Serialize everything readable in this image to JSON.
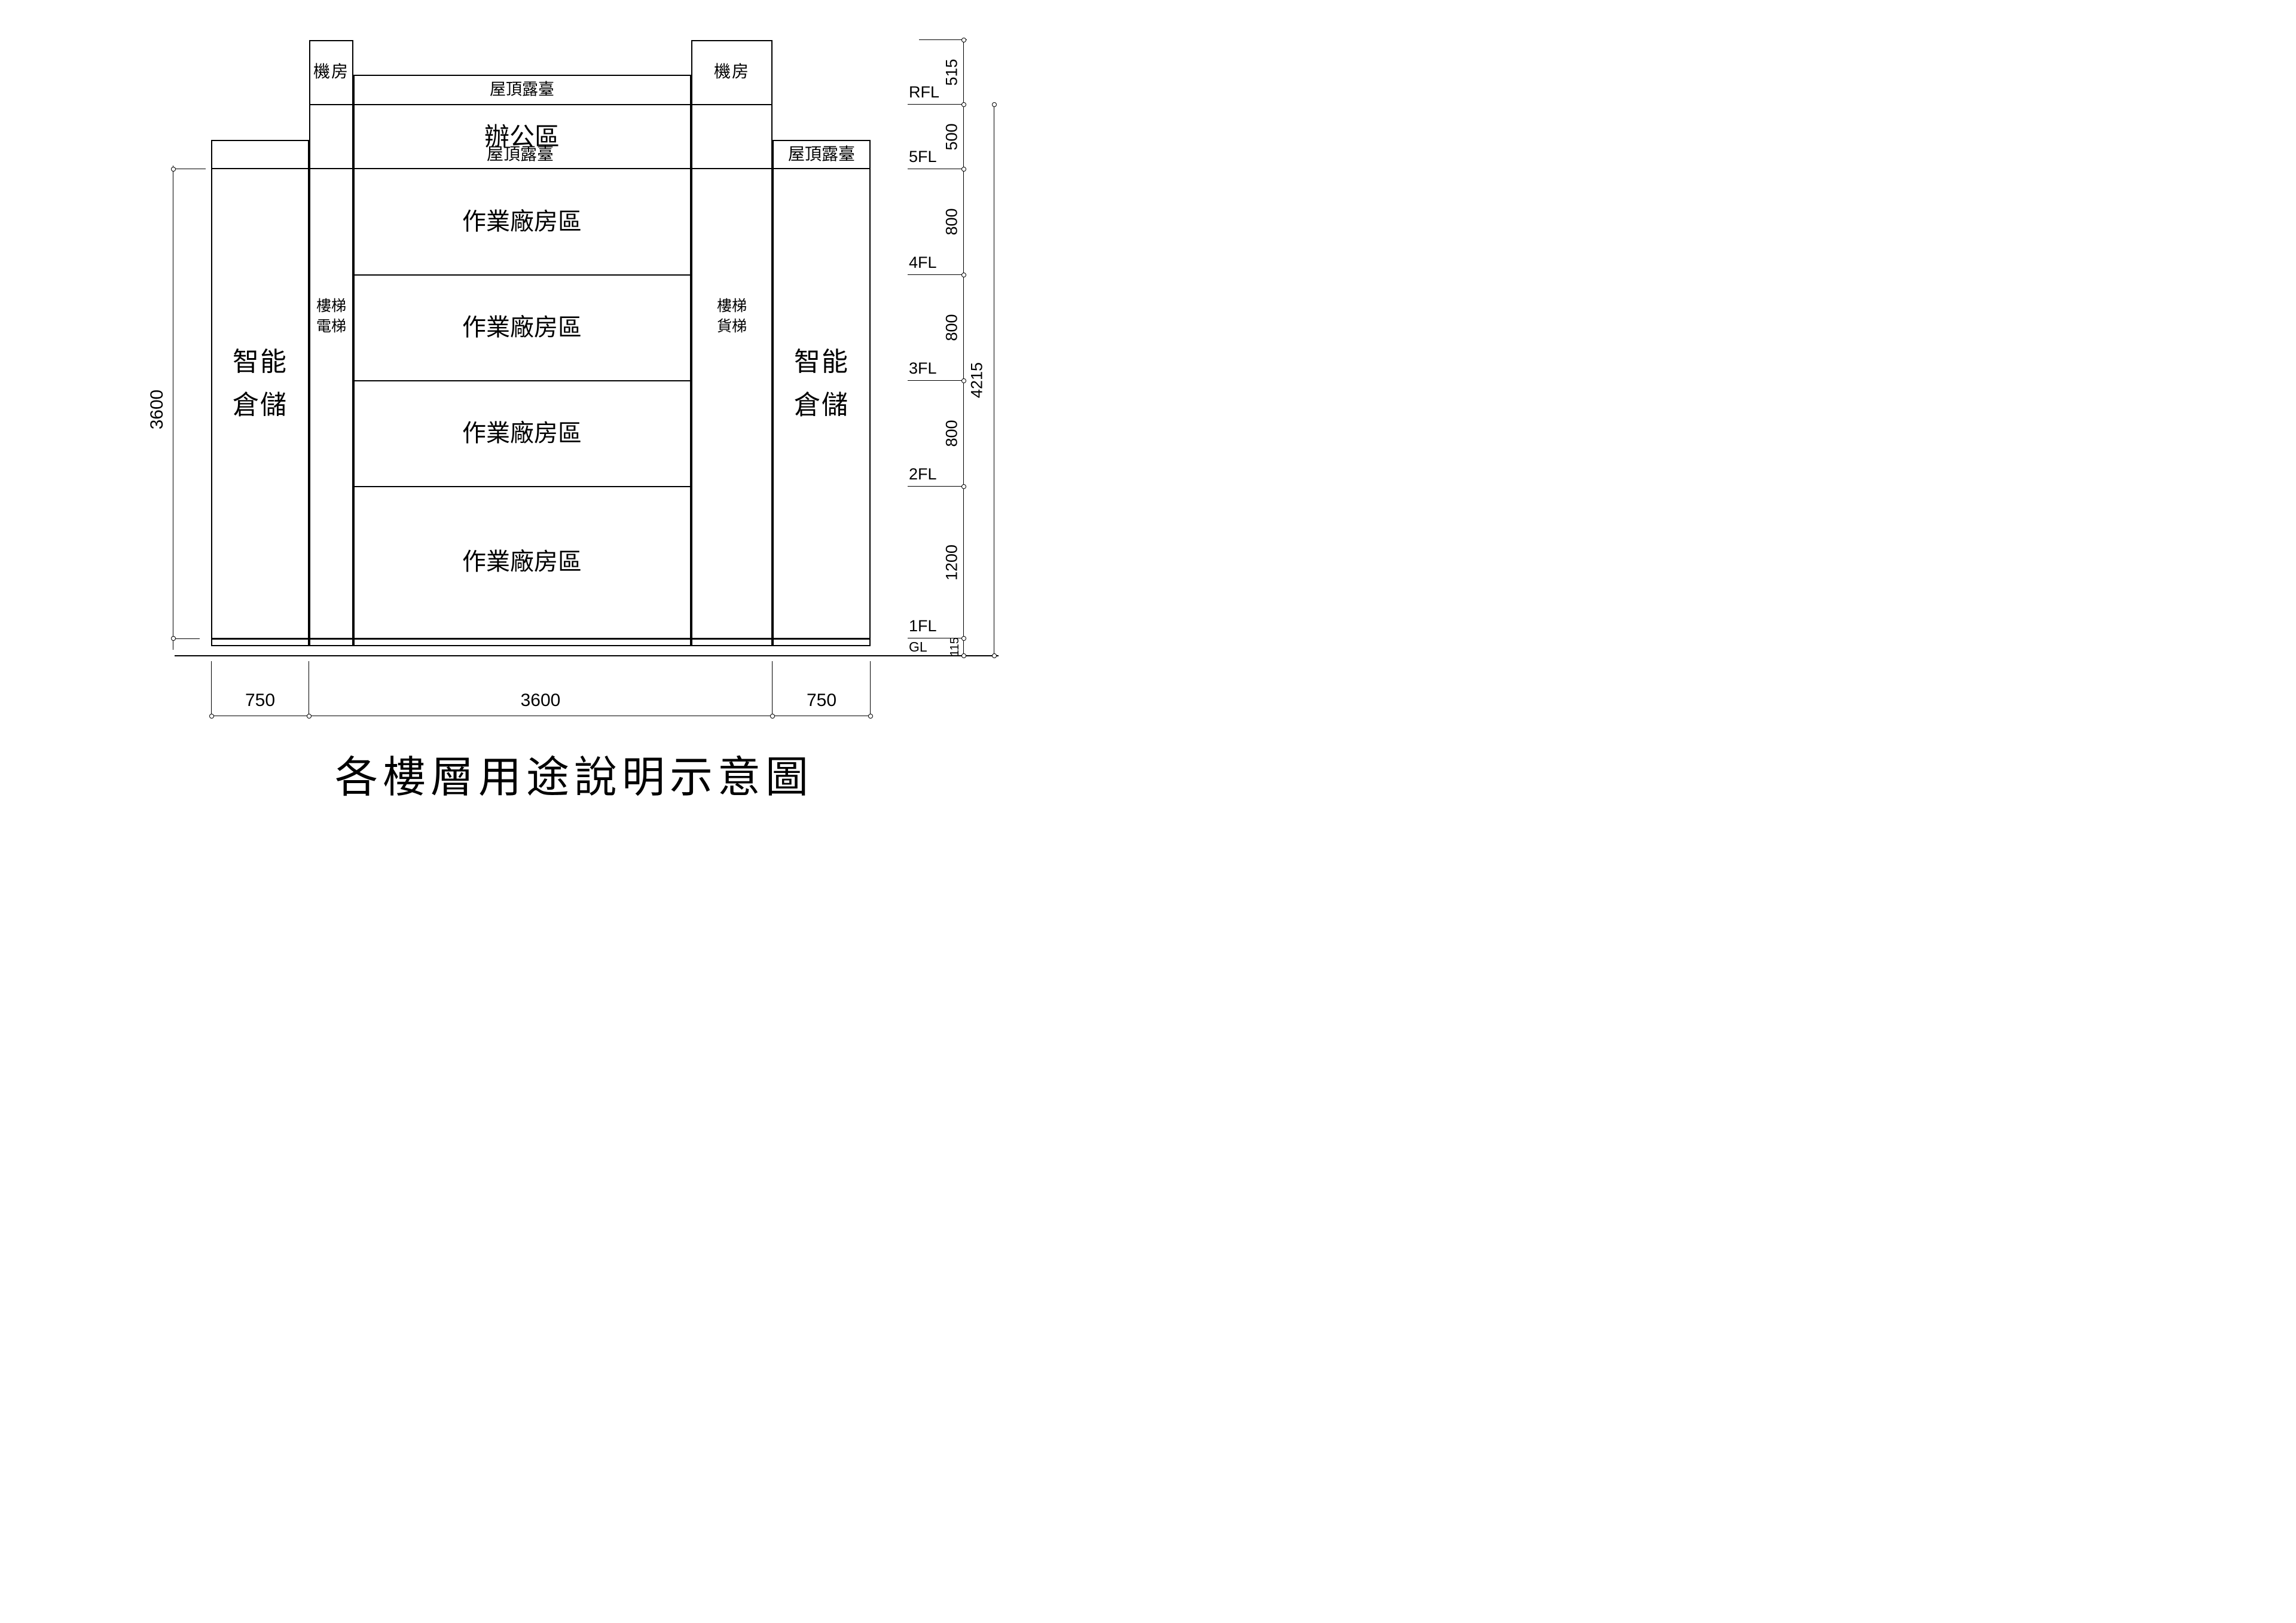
{
  "title": "各樓層用途說明示意圖",
  "building": {
    "machine_room_left": "機房",
    "machine_room_right": "機房",
    "roof_terrace_center": "屋頂露臺",
    "roof_terrace_left": "屋頂露臺",
    "roof_terrace_right": "屋頂露臺",
    "tower_left": {
      "line1": "智能",
      "line2": "倉儲"
    },
    "tower_right": {
      "line1": "智能",
      "line2": "倉儲"
    },
    "core_left": {
      "line1": "樓梯",
      "line2": "電梯"
    },
    "core_right": {
      "line1": "樓梯",
      "line2": "貨梯"
    },
    "floors": [
      "辦公區",
      "作業廠房區",
      "作業廠房區",
      "作業廠房區",
      "作業廠房區"
    ]
  },
  "levels": {
    "rfl": "RFL",
    "f5": "5FL",
    "f4": "4FL",
    "f3": "3FL",
    "f2": "2FL",
    "f1": "1FL",
    "gl": "GL"
  },
  "dimensions": {
    "vertical": {
      "machine_room": "515",
      "rfl_to_5fl": "500",
      "f5_to_f4": "800",
      "f4_to_f3": "800",
      "f3_to_f2": "800",
      "f2_to_f1": "1200",
      "f1_to_gl": "115",
      "total": "4215",
      "tower_height": "3600"
    },
    "horizontal": {
      "left_tower": "750",
      "center": "3600",
      "right_tower": "750"
    }
  },
  "colors": {
    "line": "#000000",
    "background": "#ffffff"
  }
}
